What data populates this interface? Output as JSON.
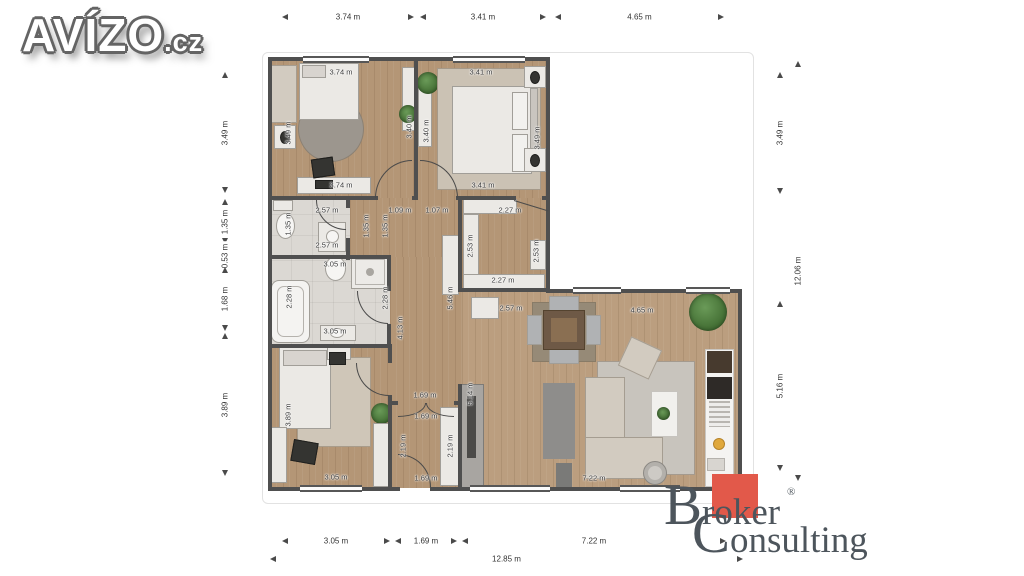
{
  "branding": {
    "avizo": {
      "name": "AVÍZO",
      "tld": ".cz"
    },
    "broker": {
      "line1": "Broker",
      "line2": "Consulting",
      "registered": "®",
      "accent_color": "#e2594a",
      "text_color": "#4d555c"
    }
  },
  "dims": {
    "top": [
      "3.74 m",
      "3.41 m",
      "4.65 m"
    ],
    "bottom": [
      "3.05 m",
      "1.69 m",
      "7.22 m"
    ],
    "bottom_total": "12.85 m",
    "left": [
      "3.49 m",
      "1.35 m",
      "0.53 m",
      "1.68 m",
      "3.89 m"
    ],
    "right": [
      "3.49 m",
      "5.16 m"
    ],
    "right_total": "12.06 m"
  },
  "plan_labels": {
    "bedroom1_top": "3.74 m",
    "bedroom1_bottom": "3.74 m",
    "bedroom1_left": "3.49 m",
    "bedroom2_top": "3.41 m",
    "bedroom2_bottom": "3.41 m",
    "bedroom2_right": "3.49 m",
    "wardrobe_left": "3.40 m",
    "wardrobe_right": "3.40 m",
    "wc_top": "2.57 m",
    "wc_bottom": "2.57 m",
    "wc_left": "1.35 m",
    "wc_right": "1.35 m",
    "hall_width1": "1.09 m",
    "hall_width2": "1.07 m",
    "hall_left": "1.35 m",
    "corridor_height": "4.13 m",
    "corridor_right": "5.46 m",
    "closet_top": "2.27 m",
    "closet_bottom": "2.27 m",
    "closet_left": "2.53 m",
    "closet_right": "2.53 m",
    "bath_top": "3.05 m",
    "bath_bottom": "3.05 m",
    "bath_left": "2.28 m",
    "bath_right": "2.28 m",
    "bedroom3_left": "3.89 m",
    "bedroom3_bottom": "3.05 m",
    "entry_top": "1.69 m",
    "entry_mid": "1.69 m",
    "entry_bottom": "1.69 m",
    "entry_left": "2.19 m",
    "entry_right": "2.19 m",
    "living_top": "4.65 m",
    "living_left": "5.14 m",
    "living_bottom": "7.22 m",
    "dining": "2.57 m"
  }
}
